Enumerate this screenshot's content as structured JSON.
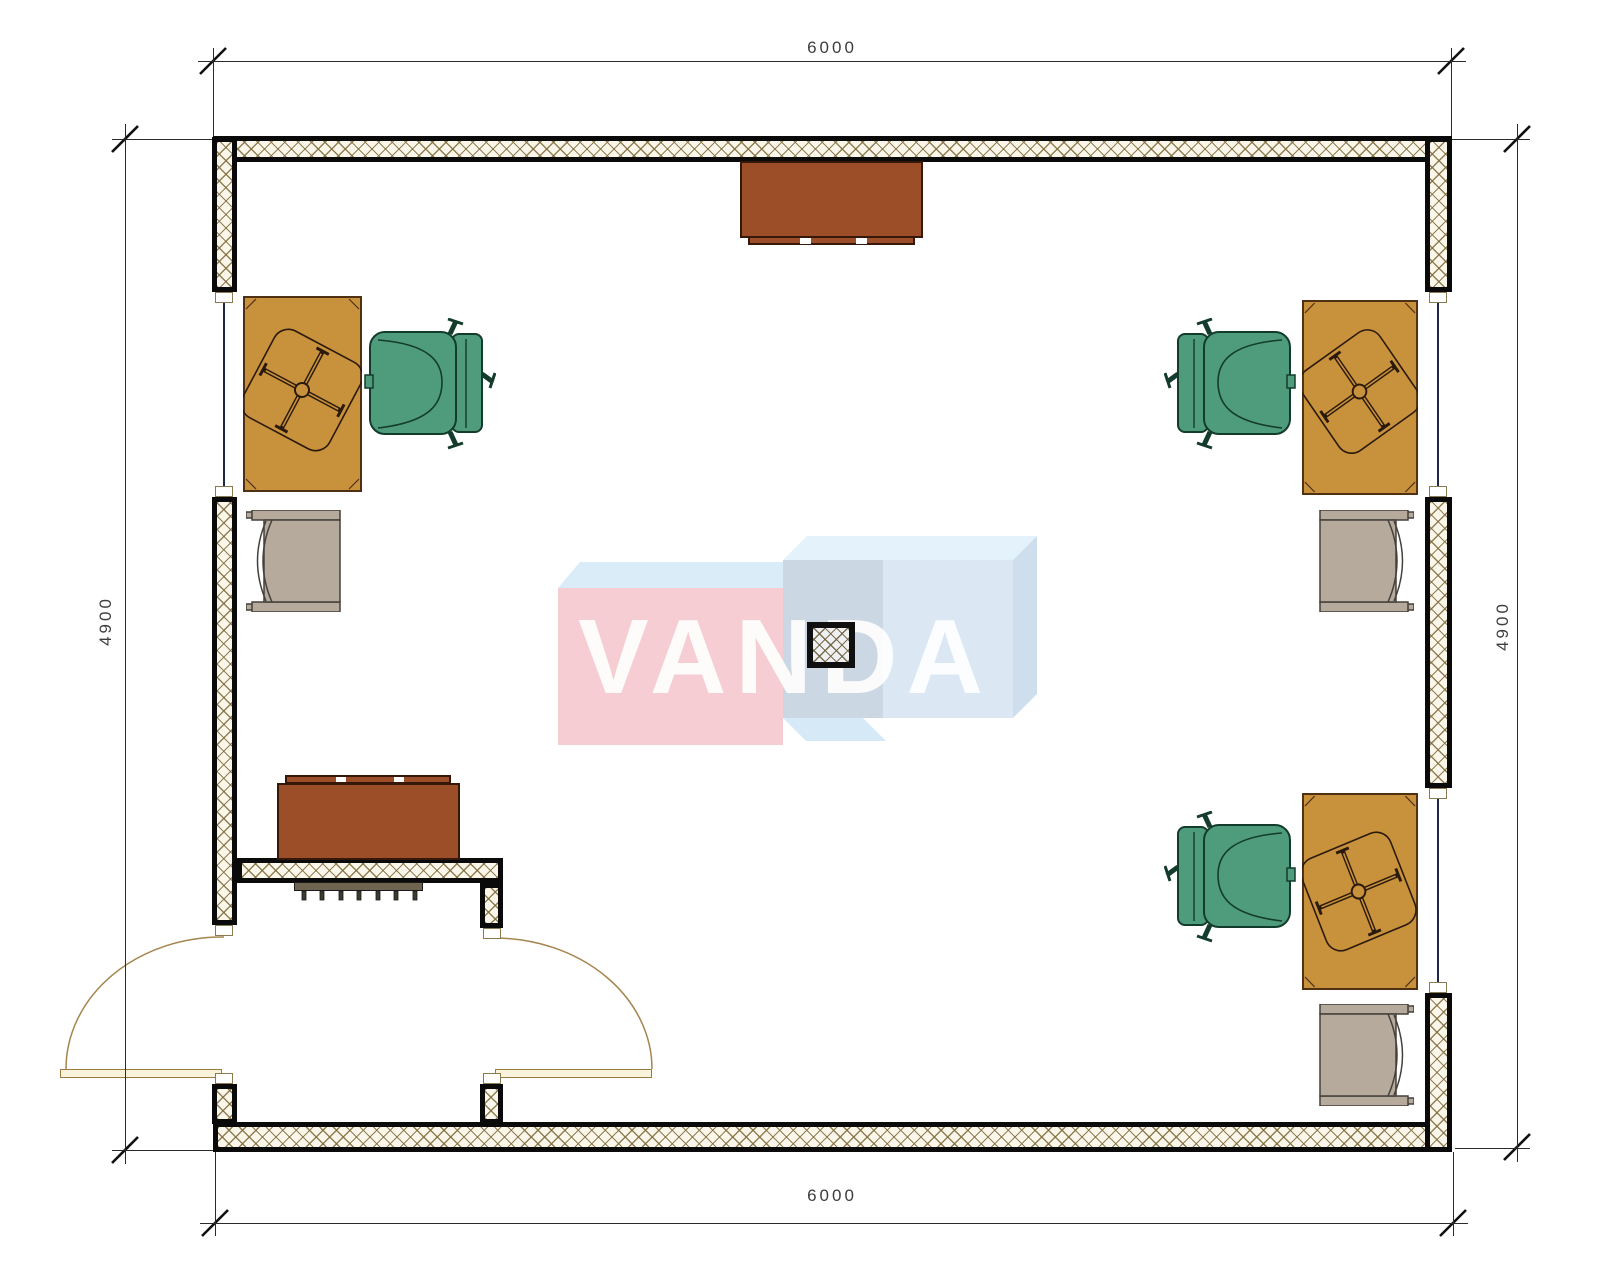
{
  "drawing": {
    "watermark": {
      "text": "VANDA",
      "pink": "#f6cdd3",
      "light_blue": "#dbe8f4"
    },
    "dimensions": {
      "top": {
        "value": "6000"
      },
      "bottom": {
        "value": "6000"
      },
      "left": {
        "value": "4900"
      },
      "right": {
        "value": "4900"
      }
    },
    "colors": {
      "wall_hatch_line": "#7e6a3a",
      "wall_fill": "#faf6ea",
      "wall_edge": "#0a0a0a",
      "desk": "#c8913c",
      "chair_green": "#4f9c7d",
      "chair_gray": "#b5aa9c",
      "cabinet": "#9b4e28",
      "radiator": "#6e6450",
      "door": "#faf3dc",
      "window_line": "#1d2749",
      "dimension_text": "#3d3d3d"
    },
    "elements": [
      "exterior-walls",
      "entrance-vestibule",
      "swing-doors-2",
      "windows-3",
      "center-column",
      "desks-3",
      "task-chair-symbols-3",
      "armchairs-green-3",
      "side-chairs-gray-3",
      "cabinets-2",
      "radiator"
    ]
  }
}
